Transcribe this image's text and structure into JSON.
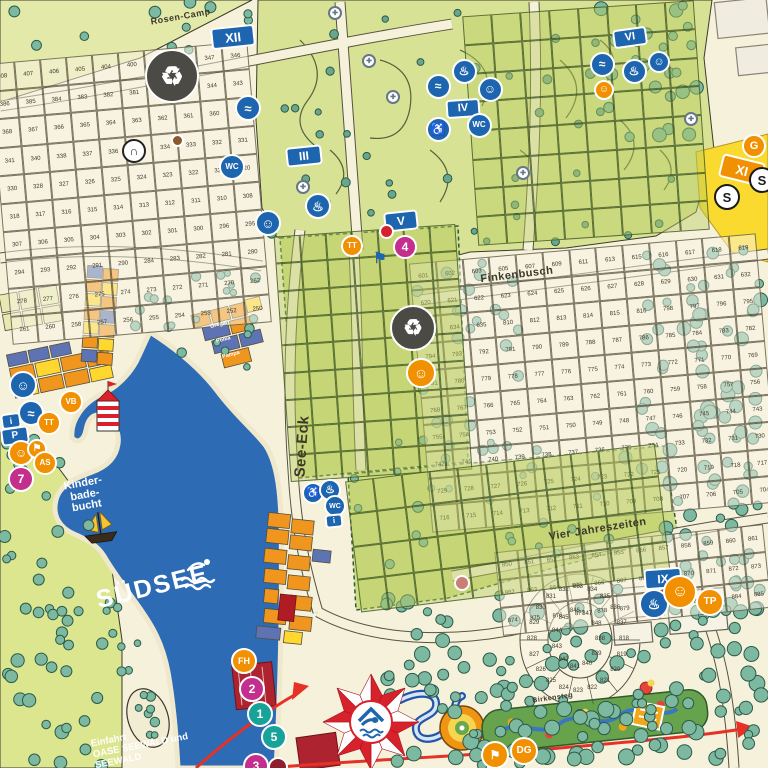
{
  "labels": {
    "lake": "SÜDSEE",
    "bay": [
      "Kinder-",
      "bade-",
      "bucht"
    ],
    "entrance": [
      "Einfahrt",
      "OASE SEEWALD und",
      "SEEWALD"
    ],
    "streets": [
      {
        "id": "rosen-camp",
        "name": "Rosen-Camp"
      },
      {
        "id": "finkenbusch",
        "name": "Finkenbusch"
      },
      {
        "id": "vier-jahreszeiten",
        "name": "Vier Jahreszeiten"
      },
      {
        "id": "see-eck",
        "name": "See-Eck"
      },
      {
        "id": "birkensteg",
        "name": "Birkensteg"
      }
    ],
    "accommodation": [
      "Gregal",
      "Polka",
      "Pampa"
    ]
  },
  "colors": {
    "lake": "#2d6bb4",
    "cream": "#f6f1da",
    "green_area": "#d8e295",
    "badge_blue": "#1d65ae",
    "badge_orange": "#f19000",
    "badge_magenta": "#c42e8d",
    "badge_teal": "#17a29a",
    "badge_red": "#d7202e",
    "tree": "#7db9a0",
    "tent_red": "#d7212b",
    "yellow_area": "#fada2e"
  },
  "badges": [
    {
      "name": "district-xii-badge",
      "shape": "rect",
      "label": "XII",
      "bg": "#1d65ae",
      "x": 233,
      "y": 37,
      "w": 44,
      "h": 22,
      "fs": 13,
      "rot": -6
    },
    {
      "name": "waste-station-icon",
      "shape": "circle",
      "glyph": "♻",
      "bg": "#4b4a45",
      "x": 172,
      "y": 76,
      "w": 54,
      "h": 54,
      "fs": 26
    },
    {
      "name": "underpass-icon",
      "shape": "circle",
      "glyph": "∩",
      "bg": "#ffffff",
      "fg": "#222222",
      "bd": "#222222",
      "x": 134,
      "y": 151,
      "w": 24,
      "h": 24,
      "fs": 12
    },
    {
      "name": "marker-dot-icon",
      "shape": "circle",
      "glyph": "",
      "bg": "#8a5a2e",
      "x": 177,
      "y": 140,
      "w": 13,
      "h": 13,
      "fs": 6
    },
    {
      "name": "sanitary-laundry-icon",
      "shape": "circle",
      "glyph": "≈",
      "bg": "#1d65ae",
      "x": 248,
      "y": 108,
      "w": 26,
      "h": 26,
      "fs": 13
    },
    {
      "name": "sanitary-wc-icon",
      "shape": "circle",
      "glyph": "WC",
      "bg": "#1d65ae",
      "x": 232,
      "y": 167,
      "w": 26,
      "h": 26,
      "fs": 8
    },
    {
      "name": "district-iii-badge",
      "shape": "rect",
      "label": "III",
      "bg": "#1d65ae",
      "x": 304,
      "y": 156,
      "w": 36,
      "h": 20,
      "fs": 12,
      "rot": -6
    },
    {
      "name": "sanitary-baby-icon",
      "shape": "circle",
      "glyph": "☺",
      "bg": "#1d65ae",
      "x": 268,
      "y": 223,
      "w": 26,
      "h": 26,
      "fs": 13
    },
    {
      "name": "sanitary-shower-icon",
      "shape": "circle",
      "glyph": "♨",
      "bg": "#1d65ae",
      "x": 318,
      "y": 206,
      "w": 26,
      "h": 26,
      "fs": 13
    },
    {
      "name": "district-v-badge",
      "shape": "rect",
      "label": "V",
      "bg": "#1d65ae",
      "x": 401,
      "y": 221,
      "w": 34,
      "h": 20,
      "fs": 12,
      "rot": -6
    },
    {
      "name": "bus-stop-4-badge",
      "shape": "circle",
      "label": "4",
      "bg": "#c42e8d",
      "x": 405,
      "y": 247,
      "w": 24,
      "h": 24,
      "fs": 12
    },
    {
      "name": "marker-red-icon",
      "shape": "circle",
      "glyph": "",
      "bg": "#d7202e",
      "x": 386,
      "y": 231,
      "w": 15,
      "h": 15,
      "fs": 6
    },
    {
      "name": "trampoline-badge",
      "shape": "circle",
      "label": "TT",
      "bg": "#f19000",
      "x": 352,
      "y": 246,
      "w": 22,
      "h": 22,
      "fs": 8
    },
    {
      "name": "district-iv-badge",
      "shape": "rect",
      "label": "IV",
      "bg": "#1d65ae",
      "x": 463,
      "y": 108,
      "w": 34,
      "h": 19,
      "fs": 11,
      "rot": -4
    },
    {
      "name": "sanitary-laundry2-icon",
      "shape": "circle",
      "glyph": "≈",
      "bg": "#1d65ae",
      "x": 438,
      "y": 86,
      "w": 25,
      "h": 25,
      "fs": 12
    },
    {
      "name": "sanitary-shower2-icon",
      "shape": "circle",
      "glyph": "♨",
      "bg": "#1d65ae",
      "x": 464,
      "y": 71,
      "w": 25,
      "h": 25,
      "fs": 12
    },
    {
      "name": "sanitary-baby2-icon",
      "shape": "circle",
      "glyph": "☺",
      "bg": "#1d65ae",
      "x": 490,
      "y": 89,
      "w": 25,
      "h": 25,
      "fs": 12
    },
    {
      "name": "sanitary-wc2-icon",
      "shape": "circle",
      "glyph": "WC",
      "bg": "#1d65ae",
      "x": 479,
      "y": 125,
      "w": 25,
      "h": 25,
      "fs": 8
    },
    {
      "name": "sanitary-access2-icon",
      "shape": "circle",
      "glyph": "♿",
      "bg": "#1d65ae",
      "x": 438,
      "y": 129,
      "w": 25,
      "h": 25,
      "fs": 12
    },
    {
      "name": "district-vi-badge",
      "shape": "rect",
      "label": "VI",
      "bg": "#1d65ae",
      "x": 630,
      "y": 37,
      "w": 34,
      "h": 19,
      "fs": 11,
      "rot": -8
    },
    {
      "name": "sanitary-laundry3-icon",
      "shape": "circle",
      "glyph": "≈",
      "bg": "#1d65ae",
      "x": 602,
      "y": 64,
      "w": 25,
      "h": 25,
      "fs": 12
    },
    {
      "name": "sanitary-shower3-icon",
      "shape": "circle",
      "glyph": "♨",
      "bg": "#1d65ae",
      "x": 634,
      "y": 71,
      "w": 25,
      "h": 25,
      "fs": 12
    },
    {
      "name": "sanitary-baby3-icon",
      "shape": "circle",
      "glyph": "☺",
      "bg": "#1d65ae",
      "x": 659,
      "y": 62,
      "w": 22,
      "h": 22,
      "fs": 11
    },
    {
      "name": "play-area-icon",
      "shape": "circle",
      "glyph": "☺",
      "bg": "#f19000",
      "x": 604,
      "y": 90,
      "w": 20,
      "h": 20,
      "fs": 10
    },
    {
      "name": "district-xi-badge",
      "shape": "rect",
      "label": "XI",
      "bg": "#f19000",
      "x": 742,
      "y": 170,
      "w": 44,
      "h": 24,
      "fs": 13,
      "rot": 14
    },
    {
      "name": "marker-g-badge",
      "shape": "circle",
      "label": "G",
      "bg": "#f19000",
      "x": 754,
      "y": 146,
      "w": 24,
      "h": 24,
      "fs": 11
    },
    {
      "name": "bus-stop-s1-badge",
      "shape": "circle",
      "label": "S",
      "bg": "#ffffff",
      "fg": "#1a1a1a",
      "bd": "#1a1a1a",
      "x": 727,
      "y": 197,
      "w": 26,
      "h": 26,
      "fs": 13
    },
    {
      "name": "bus-stop-s2-badge",
      "shape": "circle",
      "label": "S",
      "bg": "#ffffff",
      "fg": "#1a1a1a",
      "bd": "#1a1a1a",
      "x": 762,
      "y": 180,
      "w": 26,
      "h": 26,
      "fs": 13
    },
    {
      "name": "waste-station2-icon",
      "shape": "circle",
      "glyph": "♻",
      "bg": "#4b4a45",
      "x": 413,
      "y": 328,
      "w": 46,
      "h": 46,
      "fs": 22
    },
    {
      "name": "playground-slide-icon",
      "shape": "circle",
      "glyph": "☺",
      "bg": "#f19000",
      "x": 421,
      "y": 373,
      "w": 30,
      "h": 30,
      "fs": 14
    },
    {
      "name": "kids-club-icon",
      "shape": "circle",
      "glyph": "☺",
      "bg": "#1d65ae",
      "x": 23,
      "y": 385,
      "w": 28,
      "h": 28,
      "fs": 13
    },
    {
      "name": "water-play-icon",
      "shape": "circle",
      "glyph": "≈",
      "bg": "#1d65ae",
      "x": 31,
      "y": 413,
      "w": 26,
      "h": 26,
      "fs": 13
    },
    {
      "name": "info-board-icon",
      "shape": "rect",
      "glyph": "i",
      "bg": "#1d65ae",
      "x": 11,
      "y": 421,
      "w": 20,
      "h": 16,
      "fs": 9,
      "rot": -8
    },
    {
      "name": "parking-icon",
      "shape": "rect",
      "label": "P",
      "bg": "#1d65ae",
      "x": 15,
      "y": 436,
      "w": 28,
      "h": 18,
      "fs": 10,
      "rot": -8
    },
    {
      "name": "viewpoint-vb-badge",
      "shape": "circle",
      "label": "VB",
      "bg": "#f19000",
      "x": 71,
      "y": 402,
      "w": 24,
      "h": 24,
      "fs": 8
    },
    {
      "name": "trampoline2-badge",
      "shape": "circle",
      "label": "TT",
      "bg": "#f19000",
      "x": 49,
      "y": 423,
      "w": 24,
      "h": 24,
      "fs": 8
    },
    {
      "name": "playground2-icon",
      "shape": "circle",
      "glyph": "☺",
      "bg": "#f19000",
      "x": 21,
      "y": 453,
      "w": 26,
      "h": 26,
      "fs": 12
    },
    {
      "name": "playground3-icon",
      "shape": "circle",
      "glyph": "⚑",
      "bg": "#f19000",
      "x": 37,
      "y": 449,
      "w": 20,
      "h": 20,
      "fs": 10
    },
    {
      "name": "adventure-as-badge",
      "shape": "circle",
      "label": "AS",
      "bg": "#f19000",
      "x": 45,
      "y": 463,
      "w": 24,
      "h": 24,
      "fs": 8
    },
    {
      "name": "bus-stop-7-badge",
      "shape": "circle",
      "label": "7",
      "bg": "#c42e8d",
      "x": 21,
      "y": 479,
      "w": 26,
      "h": 26,
      "fs": 12
    },
    {
      "name": "access-wc-icon",
      "shape": "circle",
      "glyph": "♿",
      "bg": "#1d65ae",
      "x": 313,
      "y": 493,
      "w": 22,
      "h": 22,
      "fs": 11
    },
    {
      "name": "shower4-icon",
      "shape": "circle",
      "glyph": "♨",
      "bg": "#1d65ae",
      "x": 330,
      "y": 490,
      "w": 22,
      "h": 22,
      "fs": 11
    },
    {
      "name": "wc4-icon",
      "shape": "circle",
      "glyph": "WC",
      "bg": "#1d65ae",
      "x": 335,
      "y": 506,
      "w": 22,
      "h": 22,
      "fs": 7
    },
    {
      "name": "info2-icon",
      "shape": "rect",
      "glyph": "i",
      "bg": "#1d65ae",
      "x": 334,
      "y": 521,
      "w": 18,
      "h": 14,
      "fs": 8,
      "rot": -6
    },
    {
      "name": "ferry-fh-badge",
      "shape": "circle",
      "label": "FH",
      "bg": "#f19000",
      "x": 244,
      "y": 661,
      "w": 26,
      "h": 26,
      "fs": 9
    },
    {
      "name": "bus-stop-2-badge",
      "shape": "circle",
      "label": "2",
      "bg": "#c42e8d",
      "x": 252,
      "y": 689,
      "w": 26,
      "h": 26,
      "fs": 12
    },
    {
      "name": "bus-stop-1-badge",
      "shape": "circle",
      "label": "1",
      "bg": "#17a29a",
      "x": 260,
      "y": 714,
      "w": 26,
      "h": 26,
      "fs": 12
    },
    {
      "name": "bus-stop-5-badge",
      "shape": "circle",
      "label": "5",
      "bg": "#17a29a",
      "x": 274,
      "y": 737,
      "w": 26,
      "h": 26,
      "fs": 12
    },
    {
      "name": "bus-stop-3-badge",
      "shape": "circle",
      "label": "3",
      "bg": "#c42e8d",
      "x": 256,
      "y": 766,
      "w": 26,
      "h": 26,
      "fs": 12
    },
    {
      "name": "marker-darkred-icon",
      "shape": "circle",
      "glyph": "",
      "bg": "#8e1f2c",
      "x": 278,
      "y": 767,
      "w": 20,
      "h": 20,
      "fs": 6
    },
    {
      "name": "district-ix-badge",
      "shape": "rect",
      "label": "IX",
      "bg": "#1d65ae",
      "x": 663,
      "y": 578,
      "w": 38,
      "h": 21,
      "fs": 12,
      "rot": -4
    },
    {
      "name": "sanitary-ix-icon",
      "shape": "circle",
      "glyph": "♨",
      "bg": "#1d65ae",
      "x": 654,
      "y": 604,
      "w": 30,
      "h": 30,
      "fs": 14
    },
    {
      "name": "climbing-icon",
      "shape": "circle",
      "glyph": "☺",
      "bg": "#f19000",
      "x": 680,
      "y": 592,
      "w": 34,
      "h": 34,
      "fs": 16
    },
    {
      "name": "tp-badge",
      "shape": "circle",
      "label": "TP",
      "bg": "#f19000",
      "x": 710,
      "y": 602,
      "w": 28,
      "h": 28,
      "fs": 10
    },
    {
      "name": "dg-badge",
      "shape": "circle",
      "label": "DG",
      "bg": "#f19000",
      "x": 524,
      "y": 751,
      "w": 28,
      "h": 28,
      "fs": 10
    },
    {
      "name": "minigolf-icon",
      "shape": "circle",
      "glyph": "⚑",
      "bg": "#f19000",
      "x": 495,
      "y": 755,
      "w": 28,
      "h": 28,
      "fs": 12
    },
    {
      "name": "marker-salmon-icon",
      "shape": "circle",
      "glyph": "",
      "bg": "#c97f74",
      "x": 462,
      "y": 583,
      "w": 16,
      "h": 16,
      "fs": 6
    },
    {
      "name": "flag-marker-icon",
      "shape": "plain",
      "glyph": "⚑",
      "fg": "#1d65ae",
      "x": 380,
      "y": 258,
      "w": 18,
      "h": 18,
      "fs": 15
    },
    {
      "name": "water-tap1-icon",
      "shape": "circle",
      "glyph": "✚",
      "bg": "#ffffff",
      "fg": "#667788",
      "bd": "#667788",
      "x": 335,
      "y": 13,
      "w": 14,
      "h": 14,
      "fs": 7
    },
    {
      "name": "water-tap2-icon",
      "shape": "circle",
      "glyph": "✚",
      "bg": "#ffffff",
      "fg": "#667788",
      "bd": "#667788",
      "x": 369,
      "y": 61,
      "w": 14,
      "h": 14,
      "fs": 7
    },
    {
      "name": "water-tap3-icon",
      "shape": "circle",
      "glyph": "✚",
      "bg": "#ffffff",
      "fg": "#667788",
      "bd": "#667788",
      "x": 393,
      "y": 97,
      "w": 14,
      "h": 14,
      "fs": 7
    },
    {
      "name": "water-tap4-icon",
      "shape": "circle",
      "glyph": "✚",
      "bg": "#ffffff",
      "fg": "#667788",
      "bd": "#667788",
      "x": 303,
      "y": 187,
      "w": 14,
      "h": 14,
      "fs": 7
    },
    {
      "name": "water-tap5-icon",
      "shape": "circle",
      "glyph": "✚",
      "bg": "#ffffff",
      "fg": "#667788",
      "bd": "#667788",
      "x": 523,
      "y": 173,
      "w": 14,
      "h": 14,
      "fs": 7
    },
    {
      "name": "water-tap6-icon",
      "shape": "circle",
      "glyph": "✚",
      "bg": "#ffffff",
      "fg": "#667788",
      "bd": "#667788",
      "x": 691,
      "y": 119,
      "w": 14,
      "h": 14,
      "fs": 7
    }
  ],
  "zones": [
    {
      "id": "plots-topleft",
      "kind": "cream",
      "x": 0,
      "y": 52,
      "w": 260,
      "h": 282,
      "rot": -5,
      "cols": 10,
      "numbers": [
        408,
        407,
        406,
        405,
        404,
        400,
        349,
        348,
        347,
        346,
        386,
        385,
        384,
        383,
        382,
        381,
        380,
        345,
        344,
        343,
        368,
        367,
        366,
        365,
        364,
        363,
        362,
        361,
        360,
        342,
        341,
        340,
        338,
        337,
        336,
        335,
        334,
        333,
        332,
        331,
        330,
        328,
        327,
        326,
        325,
        324,
        323,
        322,
        321,
        320,
        318,
        317,
        316,
        315,
        314,
        313,
        312,
        311,
        310,
        308,
        307,
        306,
        305,
        304,
        303,
        302,
        301,
        300,
        296,
        295,
        294,
        293,
        292,
        291,
        290,
        284,
        283,
        282,
        281,
        280,
        278,
        277,
        276,
        275,
        274,
        273,
        272,
        271,
        270,
        262,
        261,
        260,
        258,
        257,
        256,
        255,
        254,
        253,
        252,
        250
      ]
    },
    {
      "id": "plots-east",
      "kind": "cream",
      "x": 420,
      "y": 248,
      "w": 348,
      "h": 270,
      "rot": -5,
      "cols": 13,
      "numbers": [
        601,
        602,
        603,
        605,
        607,
        609,
        611,
        613,
        615,
        616,
        617,
        618,
        619,
        620,
        621,
        622,
        623,
        624,
        625,
        626,
        627,
        628,
        629,
        630,
        631,
        632,
        633,
        634,
        635,
        810,
        812,
        813,
        814,
        815,
        816,
        798,
        797,
        796,
        795,
        794,
        793,
        792,
        791,
        790,
        789,
        788,
        787,
        786,
        785,
        784,
        783,
        782,
        781,
        780,
        779,
        778,
        777,
        776,
        775,
        774,
        773,
        772,
        771,
        770,
        769,
        768,
        767,
        766,
        765,
        764,
        763,
        762,
        761,
        760,
        759,
        758,
        757,
        756,
        755,
        754,
        753,
        752,
        751,
        750,
        749,
        748,
        747,
        746,
        745,
        744,
        743,
        742,
        741,
        740,
        739,
        738,
        737,
        736,
        735,
        734,
        733,
        732,
        731,
        730,
        729,
        728,
        727,
        726,
        725,
        724,
        723,
        722,
        721,
        720,
        719,
        718,
        717,
        716,
        715,
        714,
        713,
        712,
        711,
        710,
        709,
        708,
        707,
        706,
        705,
        704
      ]
    },
    {
      "id": "plots-vier",
      "kind": "cream",
      "x": 498,
      "y": 538,
      "w": 270,
      "h": 84,
      "rot": -6,
      "cols": 12,
      "numbers": [
        850,
        851,
        852,
        853,
        854,
        855,
        856,
        857,
        858,
        859,
        860,
        861,
        862,
        863,
        864,
        865,
        866,
        867,
        868,
        869,
        870,
        871,
        872,
        873,
        874,
        875,
        876,
        877,
        878,
        879,
        880,
        881,
        882,
        883,
        884,
        885
      ]
    },
    {
      "id": "plots-oval",
      "kind": "ring",
      "cx": 580,
      "cy": 640,
      "numbers": [
        818,
        819,
        820,
        821,
        822,
        823,
        824,
        825,
        826,
        827,
        828,
        829,
        830,
        831,
        832,
        833,
        834,
        835,
        836,
        837,
        838,
        839,
        840,
        841,
        842,
        843,
        844,
        845,
        846,
        847,
        848
      ]
    },
    {
      "id": "plots-green-mid",
      "kind": "green",
      "x": 282,
      "y": 230,
      "w": 182,
      "h": 246,
      "rot": -4,
      "cols": 7,
      "count": 63
    },
    {
      "id": "plots-green-south",
      "kind": "green",
      "x": 352,
      "y": 462,
      "w": 312,
      "h": 132,
      "rot": -7,
      "cols": 11,
      "count": 44
    },
    {
      "id": "plots-green-topright",
      "kind": "green",
      "x": 470,
      "y": 8,
      "w": 232,
      "h": 230,
      "rot": -4,
      "cols": 8,
      "count": 64
    }
  ]
}
